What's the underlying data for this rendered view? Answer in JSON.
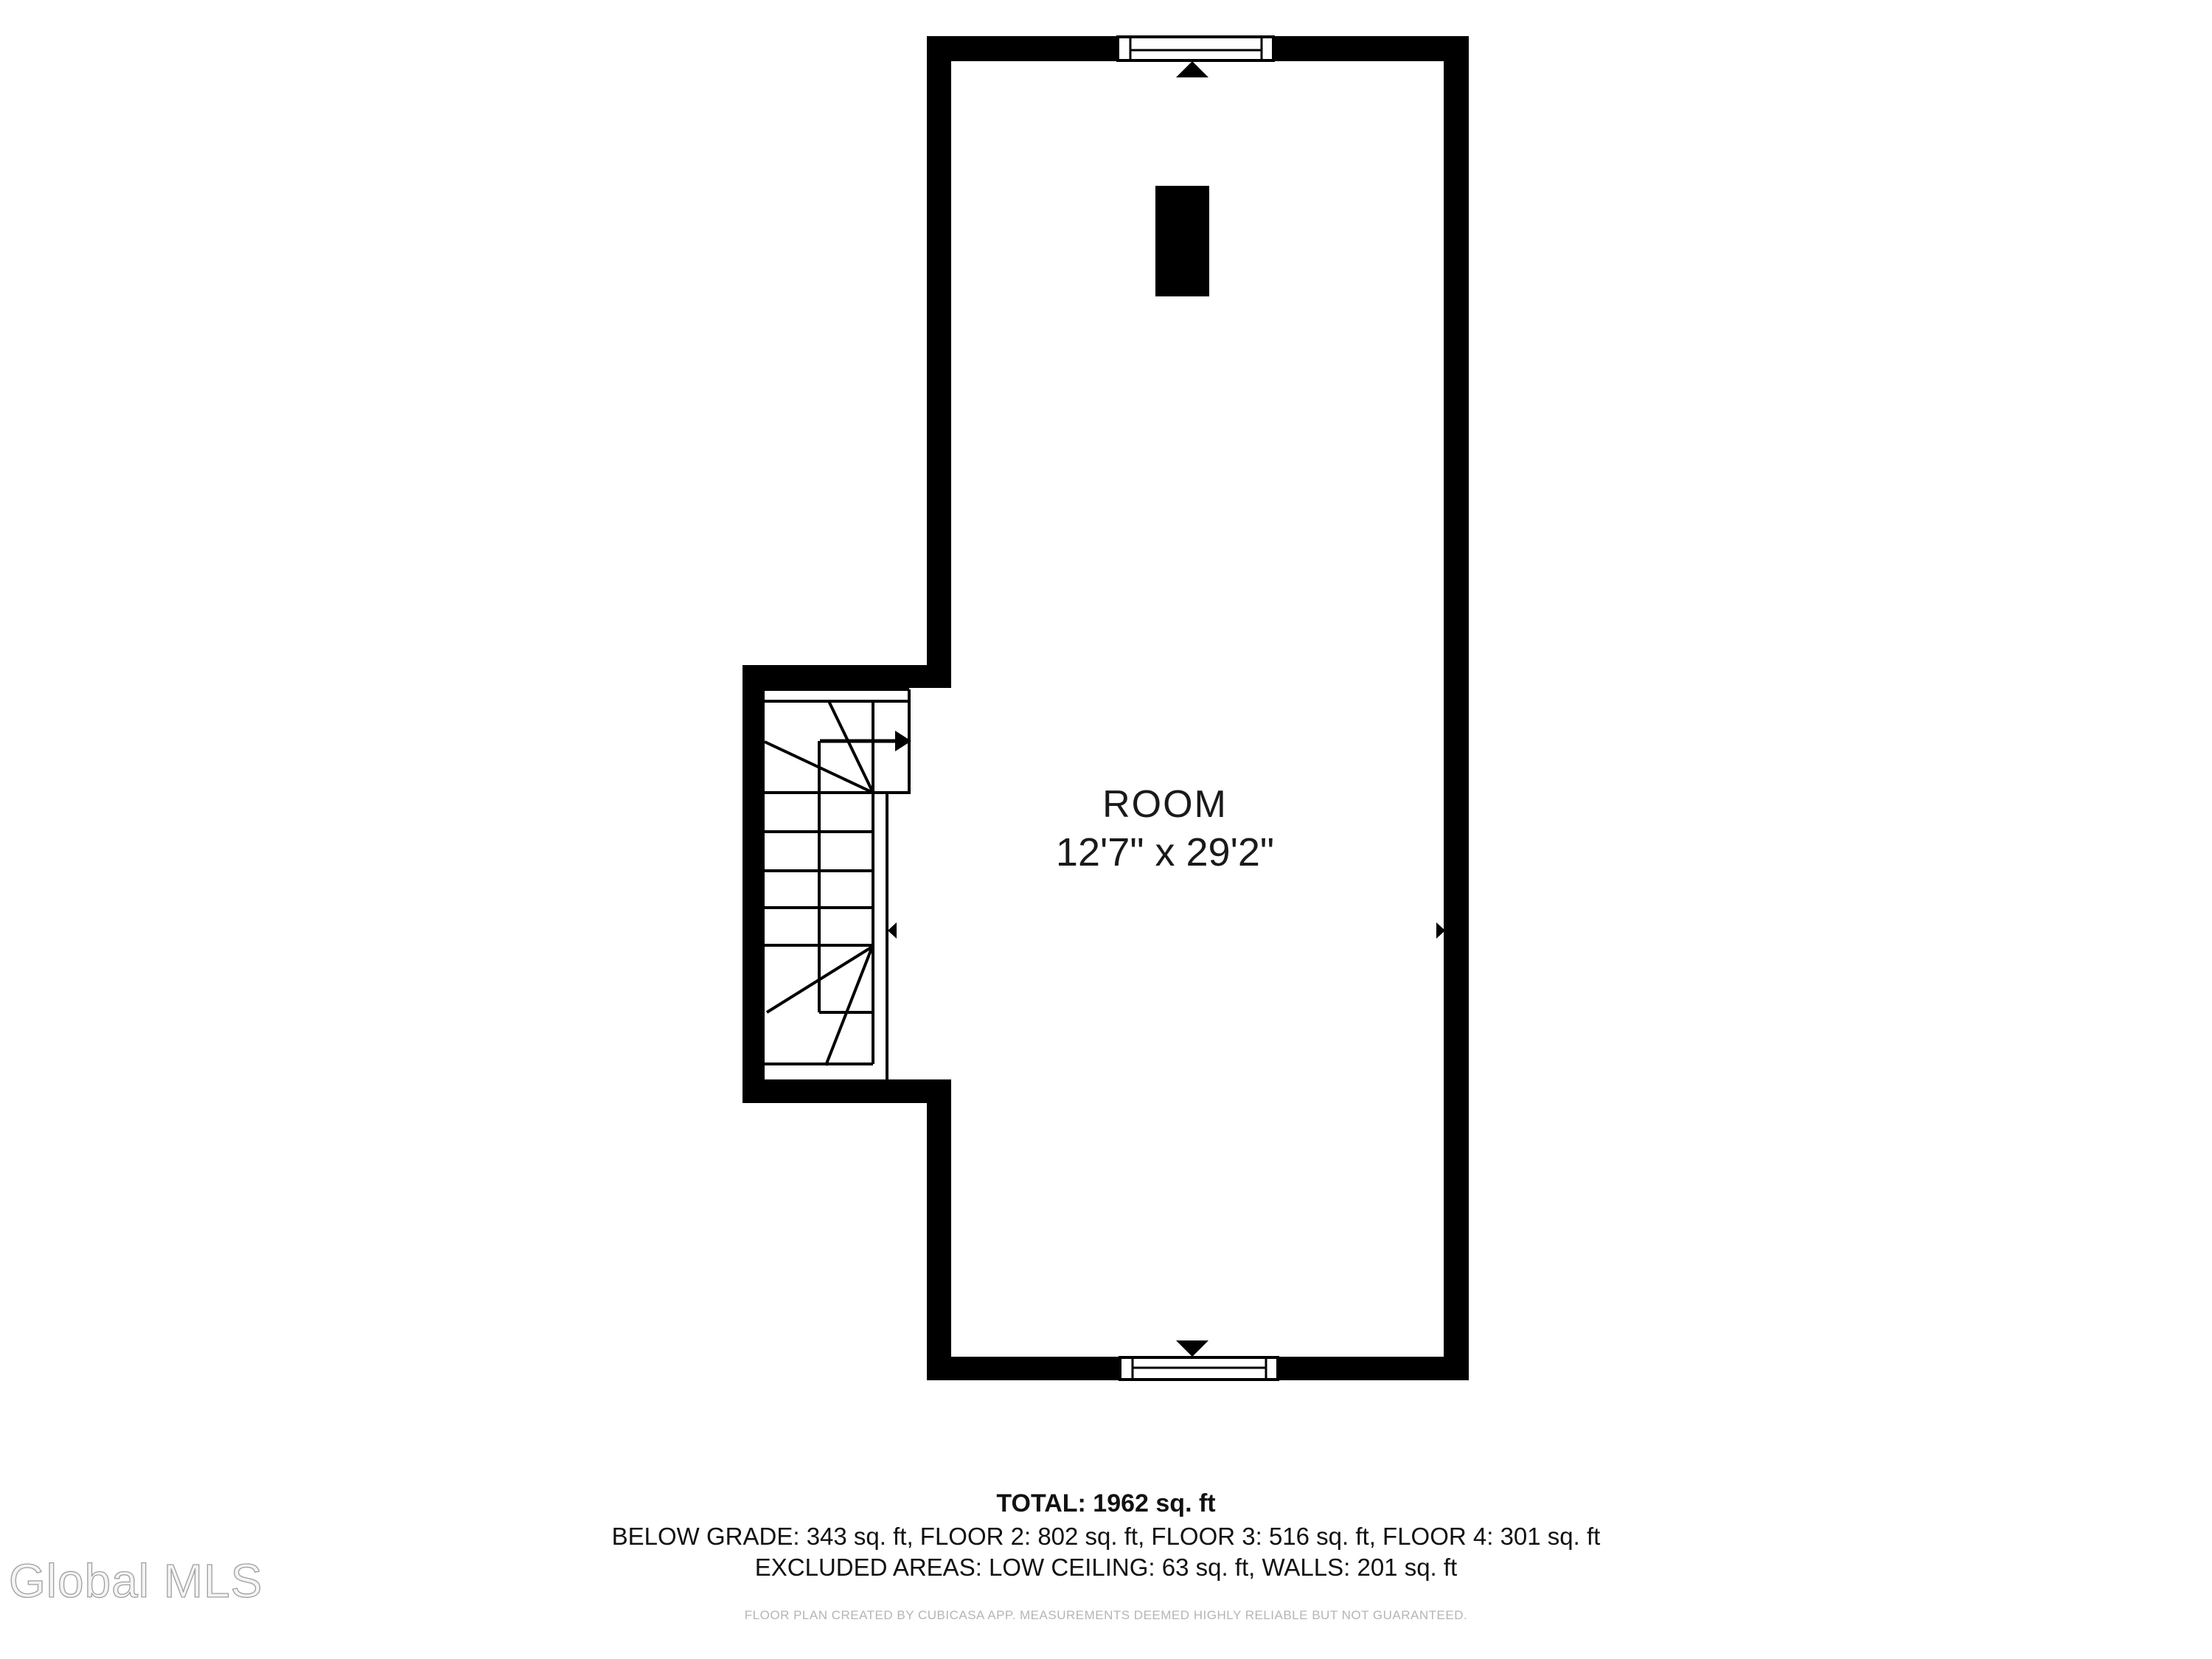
{
  "plan": {
    "room": {
      "name": "ROOM",
      "dimensions": "12'7\" x 29'2\""
    },
    "symbols": {
      "window_top": "window-symbol",
      "window_bottom": "window-symbol",
      "staircase": "winder-staircase-symbol",
      "stair_arrow": "stair-direction-arrow",
      "chimney": "chimney-block",
      "marker_top": "wall-marker-triangle-up",
      "marker_bottom": "wall-marker-triangle-down",
      "marker_left": "wall-marker-triangle-left",
      "marker_right": "wall-marker-triangle-right"
    }
  },
  "summary": {
    "total": "TOTAL: 1962 sq. ft",
    "floors": "BELOW GRADE: 343 sq. ft, FLOOR 2: 802 sq. ft, FLOOR 3: 516 sq. ft, FLOOR 4: 301 sq. ft",
    "excluded": "EXCLUDED AREAS: LOW CEILING: 63 sq. ft, WALLS: 201 sq. ft"
  },
  "areas": {
    "total_sqft": 1962,
    "below_grade_sqft": 343,
    "floor_2_sqft": 802,
    "floor_3_sqft": 516,
    "floor_4_sqft": 301,
    "low_ceiling_sqft": 63,
    "walls_sqft": 201
  },
  "footer": {
    "disclaimer": "FLOOR PLAN CREATED BY CUBICASA APP. MEASUREMENTS DEEMED HIGHLY RELIABLE BUT NOT GUARANTEED."
  },
  "watermark": {
    "text": "Global MLS"
  },
  "colors": {
    "background": "#ffffff",
    "wall": "#000000",
    "room_text": "#1a1a1a",
    "summary_text": "#111111",
    "disclaimer_text": "#b5b5b5",
    "watermark_fill": "#f4f4f4",
    "watermark_stroke": "#9e9e9e"
  }
}
